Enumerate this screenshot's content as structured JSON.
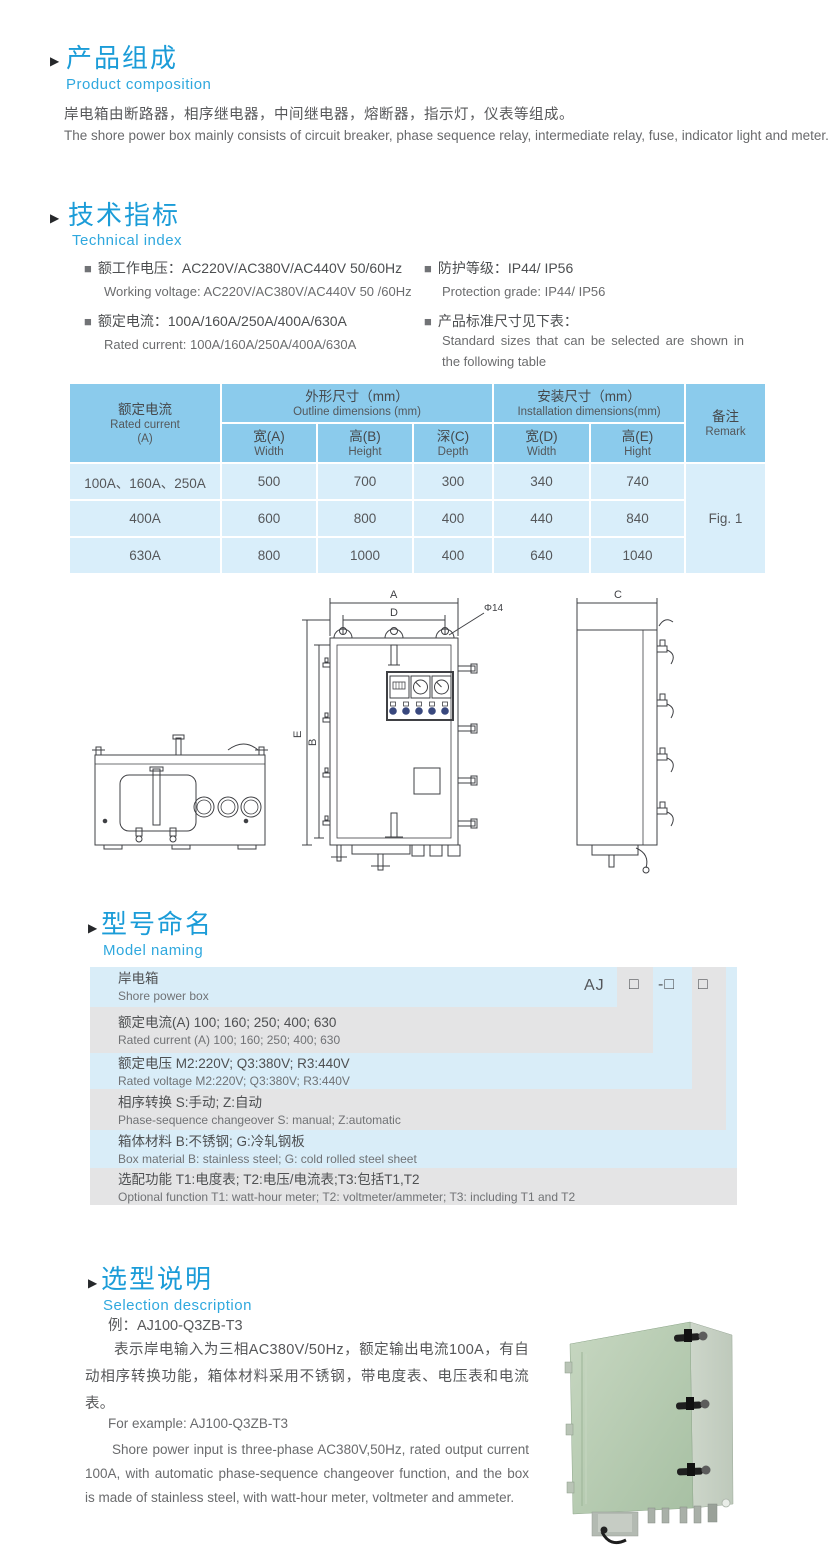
{
  "composition": {
    "title_zh": "产品组成",
    "title_en": "Product  composition",
    "body_zh": "岸电箱由断路器，相序继电器，中间继电器，熔断器，指示灯，仪表等组成。",
    "body_en": "The shore power box mainly consists of circuit breaker, phase sequence relay, intermediate relay, fuse, indicator light and meter."
  },
  "technical": {
    "title_zh": "技术指标",
    "title_en": "Technical index",
    "specs_left": [
      {
        "zh": "额工作电压：AC220V/AC380V/AC440V  50/60Hz",
        "en": "Working voltage: AC220V/AC380V/AC440V 50 /60Hz"
      },
      {
        "zh": "额定电流：100A/160A/250A/400A/630A",
        "en": "Rated current: 100A/160A/250A/400A/630A"
      }
    ],
    "specs_right": [
      {
        "zh": "防护等级：IP44/ IP56",
        "en": "Protection grade: IP44/ IP56"
      },
      {
        "zh": "产品标准尺寸见下表：",
        "en": "Standard sizes that can be selected are shown in the following table"
      }
    ]
  },
  "dimension_table": {
    "rated_current_zh": "额定电流",
    "rated_current_en": "Rated current",
    "rated_current_unit": "(A)",
    "outline_zh": "外形尺寸（mm）",
    "outline_en": "Outline dimensions (mm)",
    "install_zh": "安装尺寸（mm）",
    "install_en": "Installation dimensions(mm)",
    "remark_zh": "备注",
    "remark_en": "Remark",
    "subcols": [
      {
        "zh": "宽(A)",
        "en": "Width"
      },
      {
        "zh": "高(B)",
        "en": "Height"
      },
      {
        "zh": "深(C)",
        "en": "Depth"
      },
      {
        "zh": "宽(D)",
        "en": "Width"
      },
      {
        "zh": "高(E)",
        "en": "Hight"
      }
    ],
    "rows": [
      {
        "current": "100A、160A、250A",
        "w": "500",
        "h": "700",
        "d": "300",
        "iw": "340",
        "ih": "740"
      },
      {
        "current": "400A",
        "w": "600",
        "h": "800",
        "d": "400",
        "iw": "440",
        "ih": "840"
      },
      {
        "current": "630A",
        "w": "800",
        "h": "1000",
        "d": "400",
        "iw": "640",
        "ih": "1040"
      }
    ],
    "remark_value": "Fig. 1"
  },
  "drawing": {
    "dim_a": "A",
    "dim_b": "B",
    "dim_c": "C",
    "dim_d": "D",
    "dim_e": "E",
    "hole": "Φ14"
  },
  "naming": {
    "title_zh": "型号命名",
    "title_en": "Model naming",
    "codes": {
      "prefix": "AJ",
      "box1": "□",
      "box2": "-□",
      "box3": "□"
    },
    "rows": [
      {
        "zh": "岸电箱",
        "en": "Shore power box"
      },
      {
        "zh": "额定电流(A)  100; 160; 250; 400; 630",
        "en": "Rated current (A) 100; 160; 250; 400; 630"
      },
      {
        "zh": "额定电压   M2:220V;  Q3:380V;  R3:440V",
        "en": "Rated voltage  M2:220V;  Q3:380V;  R3:440V"
      },
      {
        "zh": "相序转换  S:手动; Z:自动",
        "en": "Phase-sequence changeover  S: manual;  Z:automatic"
      },
      {
        "zh": "箱体材料   B:不锈钢;  G:冷轧钢板",
        "en": "Box material   B: stainless steel; G: cold rolled steel sheet"
      },
      {
        "zh": "选配功能   T1:电度表;  T2:电压/电流表;T3:包括T1,T2",
        "en": "Optional function  T1: watt-hour meter; T2: voltmeter/ammeter; T3: including T1 and T2"
      }
    ]
  },
  "selection": {
    "title_zh": "选型说明",
    "title_en": "Selection description",
    "example_zh": "例：AJ100-Q3ZB-T3",
    "body_zh": "表示岸电输入为三相AC380V/50Hz，额定输出电流100A，有自动相序转换功能，箱体材料采用不锈钢，带电度表、电压表和电流表。",
    "example_en": "For example: AJ100-Q3ZB-T3",
    "body_en": "Shore power input is three-phase AC380V,50Hz, rated output current 100A, with automatic phase-sequence changeover function, and the box is made of stainless steel, with watt-hour meter, voltmeter and ammeter."
  }
}
